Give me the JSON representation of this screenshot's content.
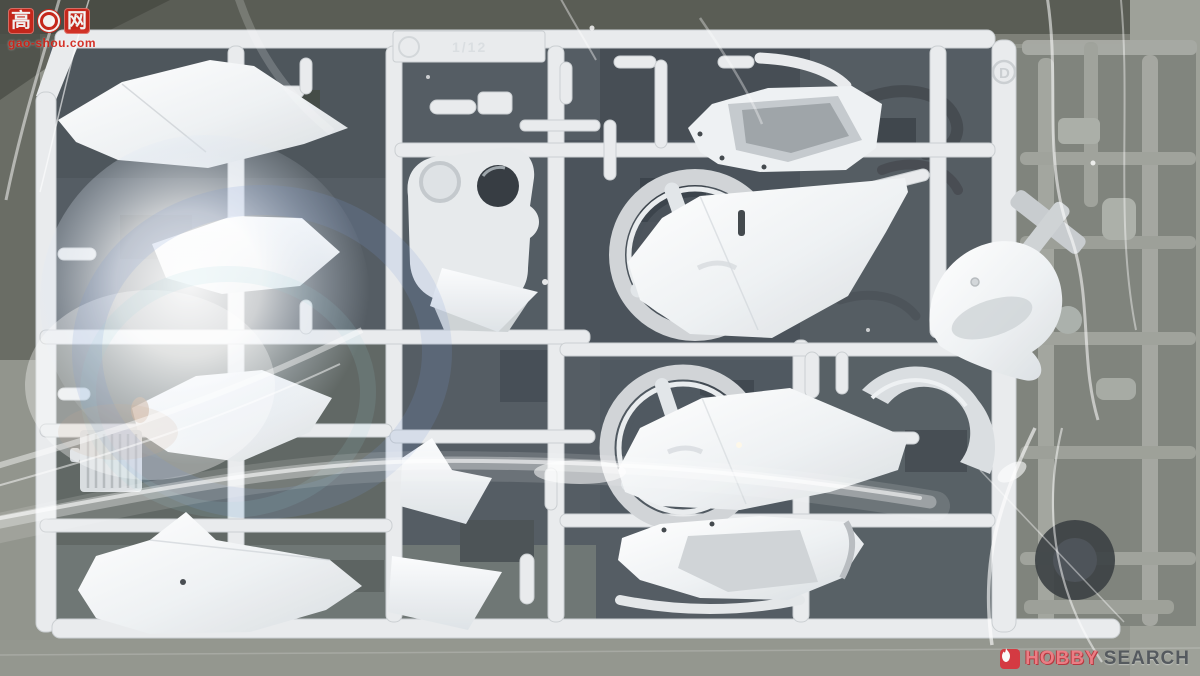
{
  "watermark": {
    "char_left": "高",
    "char_right": "网",
    "gear_icon": "gear-icon",
    "url": "gao-shou.com",
    "accent_color": "#cf2418"
  },
  "logo": {
    "icon": "flame-icon",
    "hobby": "HOBBY",
    "search": "SEARCH",
    "hobby_color": "#ef7c84",
    "search_color": "#52575c",
    "icon_bg": "#d8363e"
  },
  "sprue": {
    "tag_text": "1/12",
    "runner_letter_right": "D",
    "plastic_color": "#eceff1",
    "gray_sprue_color": "#9da099",
    "dark_part_color": "#343a40",
    "background_color": "#8e9188",
    "interior_color": "#4e565e"
  }
}
